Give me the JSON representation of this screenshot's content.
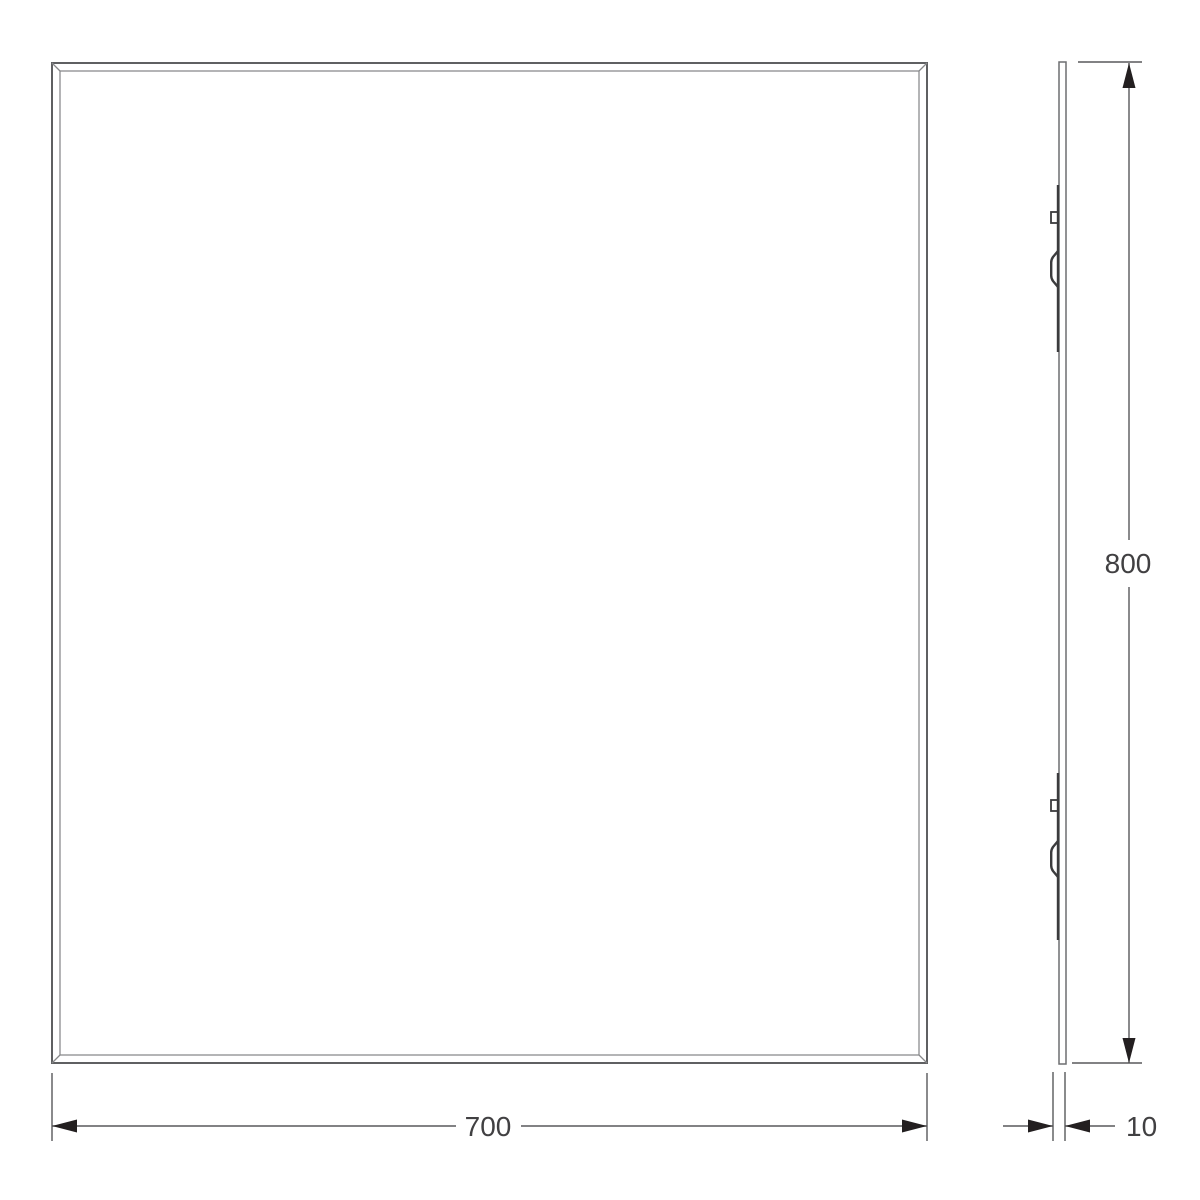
{
  "drawing": {
    "kind": "two-view technical drawing of a bevelled rectangular mirror panel",
    "views": {
      "front": "front-view",
      "side": "side-profile-view"
    }
  },
  "dimensions": {
    "width": {
      "value": "700"
    },
    "height": {
      "value": "800"
    },
    "thickness": {
      "value": "10"
    }
  },
  "colors": {
    "background": "#ffffff",
    "edge-dark": "#5f6062",
    "edge-light": "#87888a",
    "line-gray": "#6d6e71",
    "bracket-dark": "#3b3b3d",
    "dim-line": "#58595b",
    "arrow-dark": "#231f20",
    "text-dark": "#414042"
  }
}
